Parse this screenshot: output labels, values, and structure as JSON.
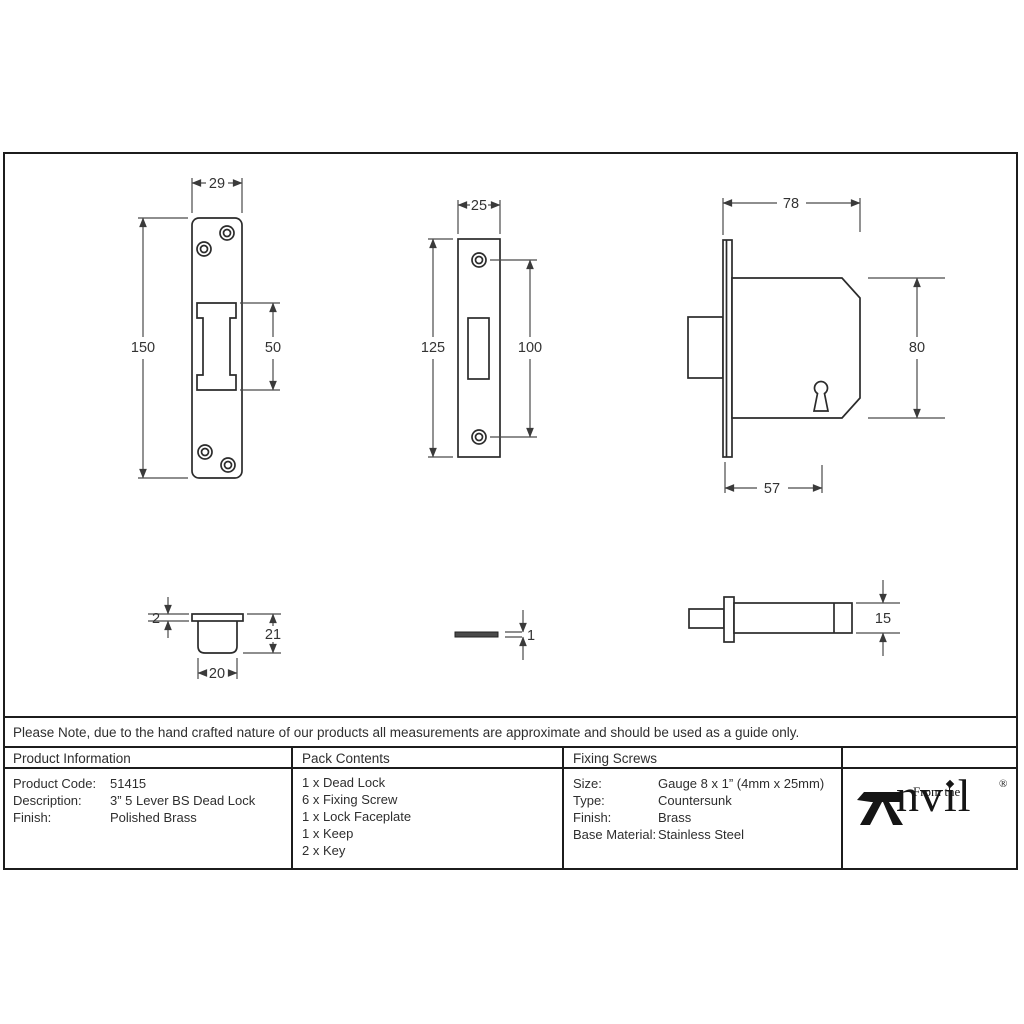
{
  "note": "Please Note, due to the hand crafted nature of our products all measurements are approximate and should be used as a guide only.",
  "dimensions": {
    "keep_front": {
      "width": "29",
      "height": "150",
      "slot_height": "50"
    },
    "faceplate_front": {
      "width": "25",
      "height": "125",
      "hole_spacing": "100"
    },
    "lock_side": {
      "width": "78",
      "height": "80",
      "backset": "57"
    },
    "keep_side": {
      "flange_thickness": "2",
      "depth": "21",
      "width": "20"
    },
    "faceplate_side": {
      "thickness": "1"
    },
    "lock_top": {
      "thickness": "15"
    }
  },
  "table": {
    "product_information": {
      "header": "Product Information",
      "rows": [
        {
          "label": "Product Code:",
          "value": "51415"
        },
        {
          "label": "Description:",
          "value": "3” 5 Lever BS Dead Lock"
        },
        {
          "label": "Finish:",
          "value": "Polished Brass"
        }
      ]
    },
    "pack_contents": {
      "header": "Pack Contents",
      "items": [
        "1 x Dead Lock",
        "6 x Fixing Screw",
        "1 x Lock Faceplate",
        "1 x Keep",
        "2 x Key"
      ]
    },
    "fixing_screws": {
      "header": "Fixing Screws",
      "rows": [
        {
          "label": "Size:",
          "value": "Gauge 8 x 1” (4mm x 25mm)"
        },
        {
          "label": "Type:",
          "value": "Countersunk"
        },
        {
          "label": "Finish:",
          "value": "Brass"
        },
        {
          "label": "Base Material:",
          "value": "Stainless Steel"
        }
      ]
    },
    "logo": {
      "prefix": "From the",
      "name_rest": "nv",
      "name_i": "ı",
      "name_end": "l",
      "registered": "®"
    }
  }
}
